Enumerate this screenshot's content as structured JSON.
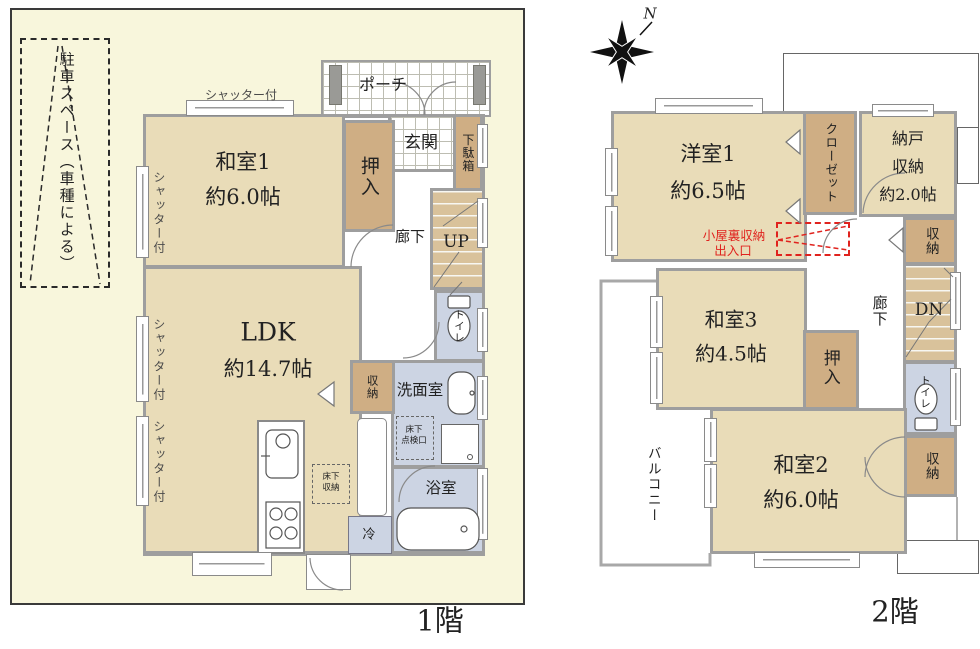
{
  "colors": {
    "site_bg": "#f8f6dc",
    "room_tan": "#e9dcb8",
    "closet_brown": "#cfae84",
    "wet_blue": "#ccd4e3",
    "stairs_tan": "#d9c29b",
    "wall_gray": "#9e9e9e",
    "accent_red": "#e0231e"
  },
  "compass": {
    "n": "N"
  },
  "floor1": {
    "floor_label": "1階",
    "parking_label": "駐車スペース（車種による）",
    "shutter_label": "シャッター付",
    "porch": "ポーチ",
    "genkan": "玄関",
    "getabako": "下駄箱",
    "washitsu1": {
      "name": "和室1",
      "size": "約6.0帖"
    },
    "oshiire": "押入",
    "corridor": "廊下",
    "stairs_up": "UP",
    "toilet": "トイレ",
    "senmen": "洗面室",
    "tenkenko": {
      "l1": "床下",
      "l2": "点検口"
    },
    "ldk": {
      "name": "LDK",
      "size": "約14.7帖"
    },
    "shuno": "収納",
    "yukashita": {
      "l1": "床下",
      "l2": "収納"
    },
    "fridge": "冷",
    "bath": "浴室"
  },
  "floor2": {
    "floor_label": "2階",
    "yoshitsu1": {
      "name": "洋室1",
      "size": "約6.5帖"
    },
    "closet": "クローゼット",
    "nando": {
      "l1": "納戸",
      "l2": "収納",
      "l3": "約2.0帖"
    },
    "koyaura": {
      "l1": "小屋裏収納",
      "l2": "出入口"
    },
    "shuno_upper": "収納",
    "stairs_dn": "DN",
    "corridor": "廊下",
    "washitsu3": {
      "name": "和室3",
      "size": "約4.5帖"
    },
    "oshiire": "押入",
    "toilet": "トイレ",
    "shuno_lower": "収納",
    "washitsu2": {
      "name": "和室2",
      "size": "約6.0帖"
    },
    "balcony": "バルコニー"
  }
}
